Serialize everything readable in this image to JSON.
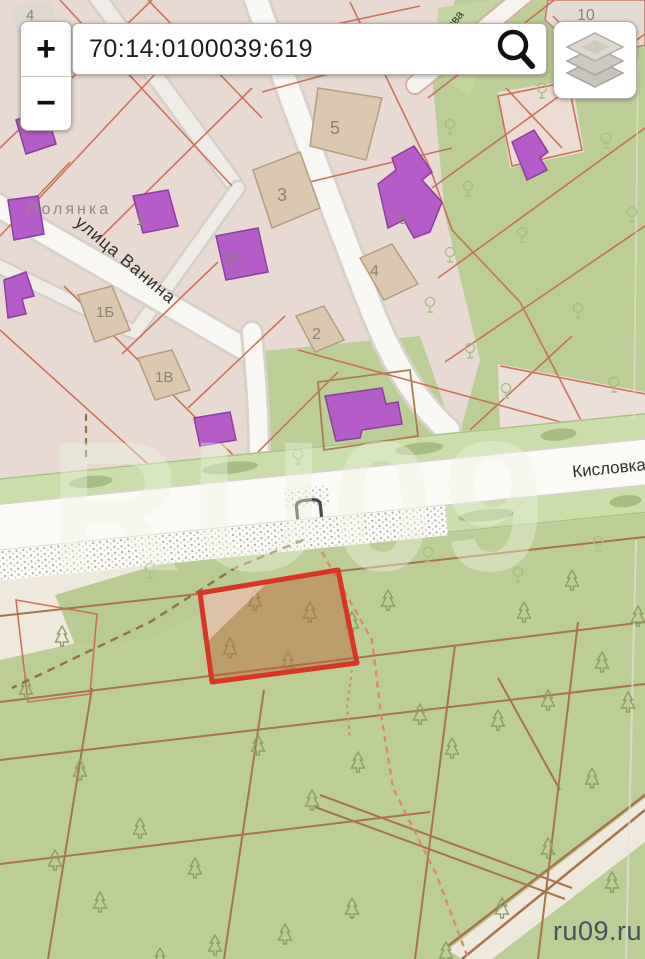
{
  "ui": {
    "zoom_in": "+",
    "zoom_out": "−",
    "search": {
      "value": "70:14:0100039:619",
      "icon": "magnifier"
    },
    "layers_button": {
      "icon": "stacked-layers"
    }
  },
  "map": {
    "streets": [
      {
        "name": "Полянка"
      },
      {
        "name": "улица Ванина"
      },
      {
        "name": "Кисловка"
      },
      {
        "name": "ова"
      }
    ],
    "parcel_numbers": [
      {
        "text": "4",
        "x": 26,
        "y": 20,
        "size": 15
      },
      {
        "text": "10",
        "x": 577,
        "y": 20,
        "size": 16
      },
      {
        "text": "5",
        "x": 330,
        "y": 134,
        "size": 18
      },
      {
        "text": "3",
        "x": 277,
        "y": 201,
        "size": 18
      },
      {
        "text": "1",
        "x": 136,
        "y": 225,
        "size": 15
      },
      {
        "text": "1А",
        "x": 224,
        "y": 263,
        "size": 15
      },
      {
        "text": "4",
        "x": 370,
        "y": 276,
        "size": 16
      },
      {
        "text": "2",
        "x": 312,
        "y": 339,
        "size": 16
      },
      {
        "text": "1Б",
        "x": 96,
        "y": 317,
        "size": 15
      },
      {
        "text": "1В",
        "x": 155,
        "y": 382,
        "size": 15
      },
      {
        "text": "6",
        "x": 398,
        "y": 224,
        "size": 15
      }
    ]
  },
  "watermarks": {
    "center": "RU09",
    "corner": "ru09.ru"
  },
  "colors": {
    "highlight_border": "#d93526",
    "highlight_fill": "rgba(186,98,58,0.45)",
    "urban_parcel_line": "#c96e52",
    "forest_parcel_line": "#a7744b",
    "building_purple": "#b45cc7",
    "building_beige": "#dbc7ae",
    "green_area": "#bccd95",
    "urban_area": "#e8dad3"
  }
}
